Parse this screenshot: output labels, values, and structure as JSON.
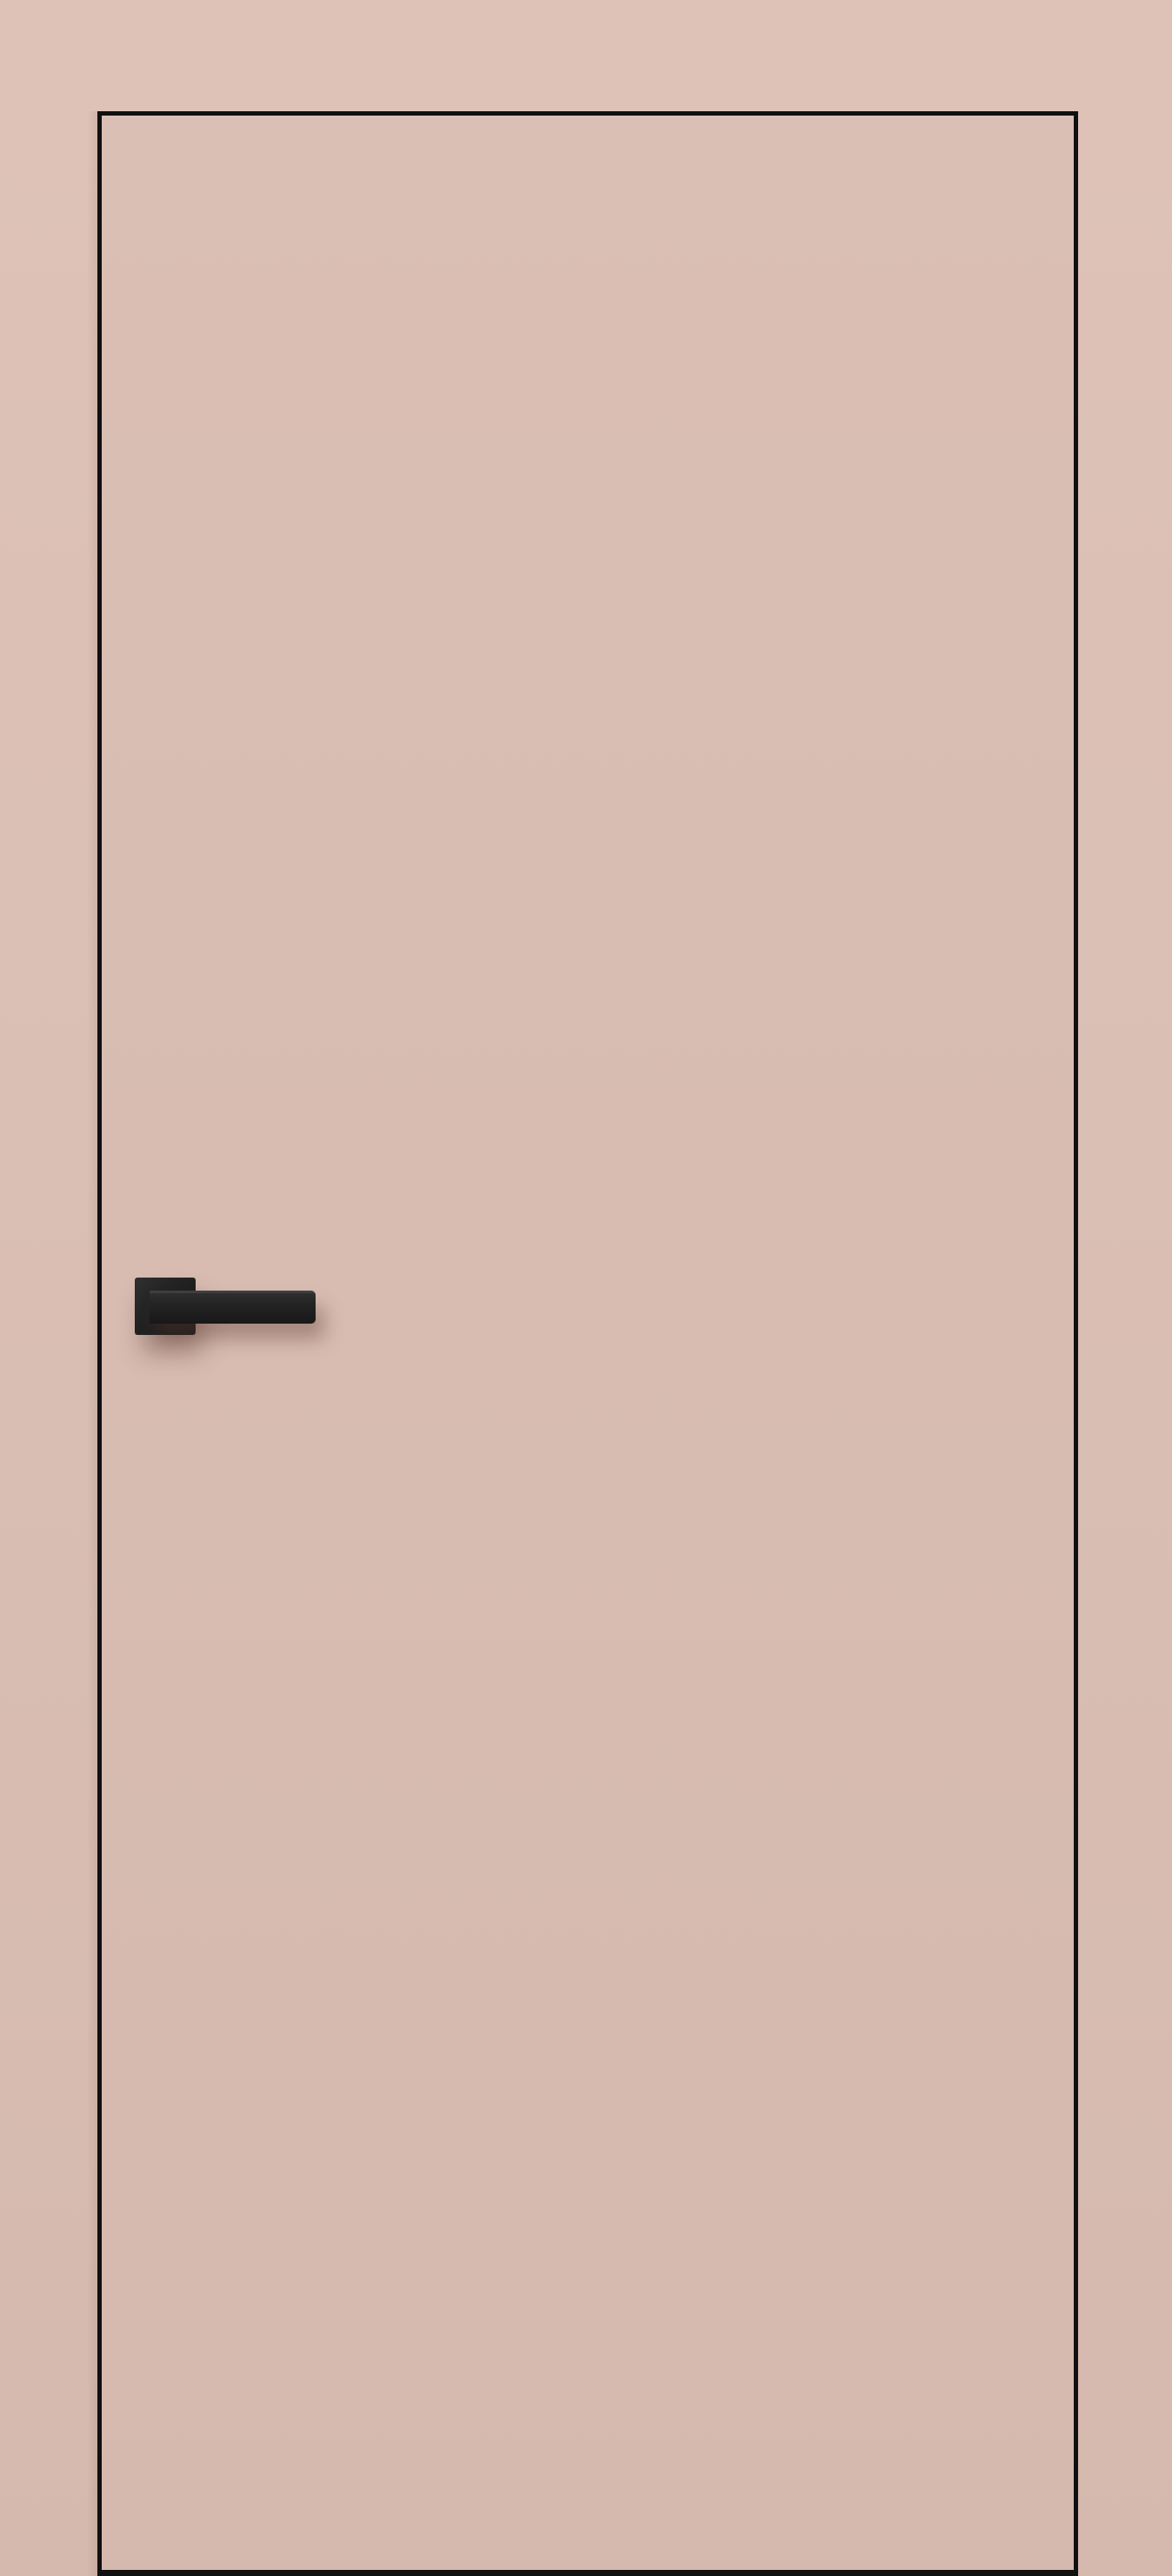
{
  "scene": {
    "kind": "product-photo",
    "subject": "frameless flush interior door with concealed frame, painted same dusty-pink as the wall, dark edge trim and matte-black square-rosette lever handle on the left side"
  },
  "colors": {
    "wall_top": "#dec2b8",
    "wall_bottom": "#d5b9ae",
    "door_face": "#dabfb5",
    "edge_trim": "#101010",
    "handle_dark": "#181818",
    "handle_mid": "#242424",
    "handle_light": "#303030",
    "shadow_soft": "rgba(92,58,47,0.40)"
  },
  "objects": {
    "wall": "painted wall surface",
    "door": "door leaf outlined by thin black edge",
    "handle_rosette": "square handle rosette",
    "handle_lever": "straight lever grip pointing right"
  }
}
